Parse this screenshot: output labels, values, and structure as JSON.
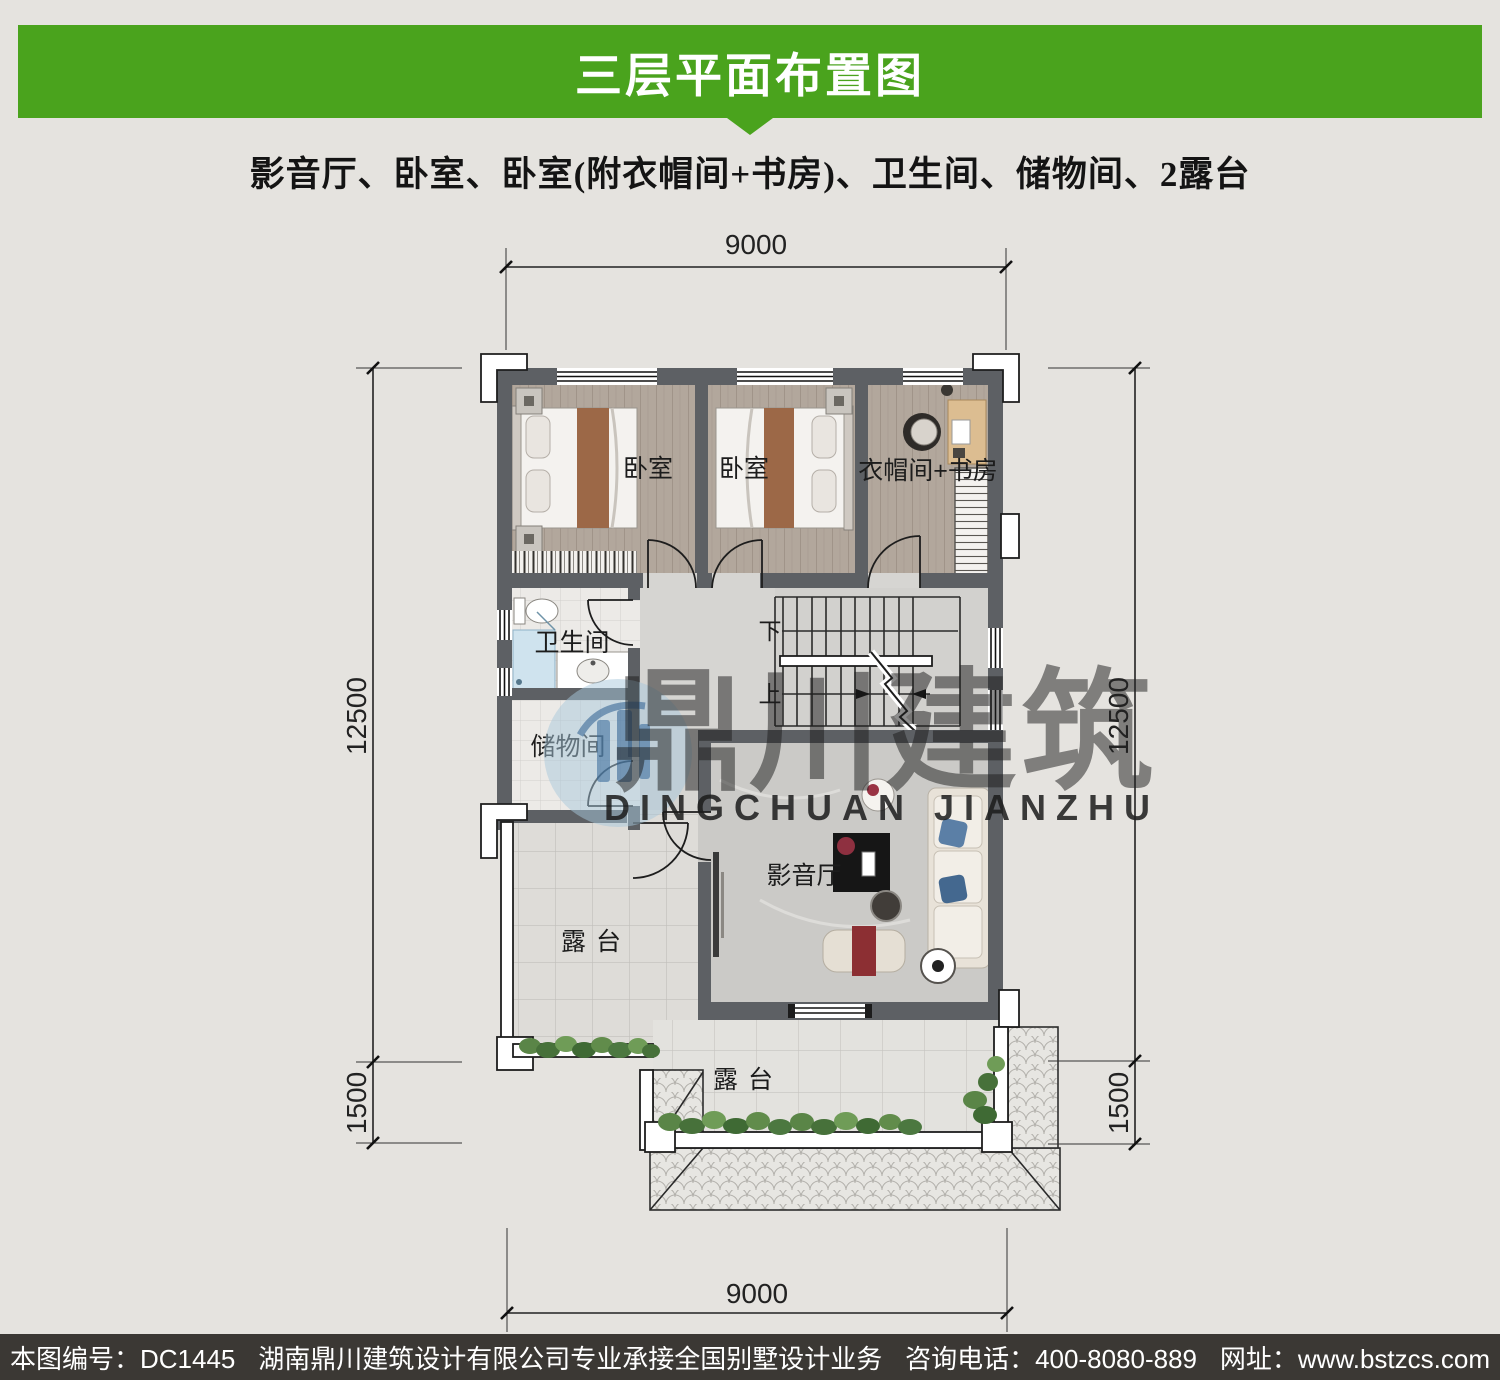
{
  "header": {
    "title": "三层平面布置图",
    "subtitle": "影音厅、卧室、卧室(附衣帽间+书房)、卫生间、储物间、2露台"
  },
  "plan": {
    "rooms": {
      "bedroom1": "卧室",
      "bedroom2": "卧室",
      "cloak_study": "衣帽间+书房",
      "bathroom": "卫生间",
      "storage": "储物间",
      "media_room": "影音厅",
      "terrace_upper": "露台",
      "terrace_lower": "露台"
    },
    "stairs": {
      "down": "下",
      "up": "上"
    },
    "dimensions": {
      "top": "9000",
      "bottom": "9000",
      "left_main": "12500",
      "left_eave": "1500",
      "right_main": "12500",
      "right_eave": "1500"
    }
  },
  "watermark": {
    "name_cn": "鼎川建筑",
    "name_en": "DINGCHUAN JIANZHU"
  },
  "footer": {
    "drawing_no": "本图编号：DC1445",
    "company": "湖南鼎川建筑设计有限公司专业承接全国别墅设计业务",
    "phone": "咨询电话：400-8080-889",
    "website": "网址：www.bstzcs.com"
  },
  "colors": {
    "banner_green": "#4aa31d",
    "wall_gray": "#5d6064",
    "footer_bg": "#3b3834",
    "page_bg": "#e5e3df"
  }
}
